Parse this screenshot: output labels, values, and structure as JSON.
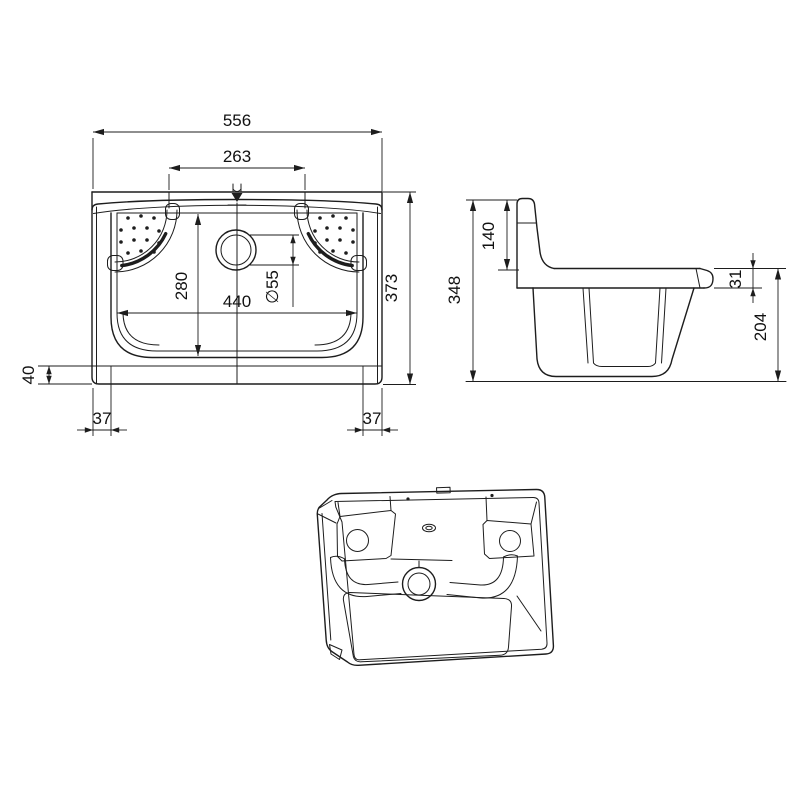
{
  "page": {
    "background": "#ffffff",
    "line_color": "#1d1d1d"
  },
  "dims": {
    "front": {
      "overall_width": "556",
      "tap_hole_spacing": "263",
      "overall_height": "373",
      "bowl_depth_front": "280",
      "bowl_width": "440",
      "drain_diameter": "∅55",
      "plinth_height": "40",
      "wall_offset_left": "37",
      "wall_offset_right": "37"
    },
    "side": {
      "overall_height": "348",
      "backsplash_height": "140",
      "rim_thickness": "31",
      "bowl_depth": "204"
    }
  }
}
